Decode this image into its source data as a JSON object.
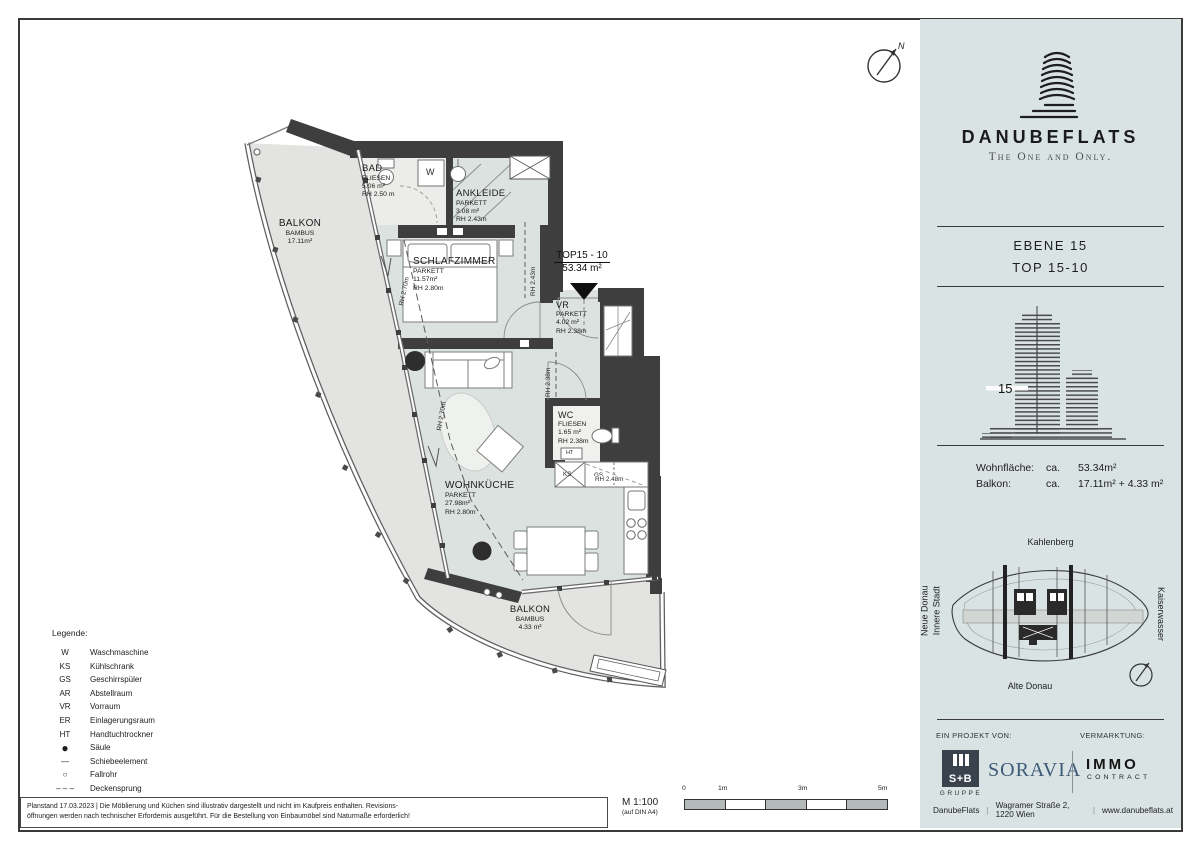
{
  "plan": {
    "compass": "N",
    "unit_callout": {
      "id": "TOP15 - 10",
      "area": "53.34 m²"
    },
    "rooms": {
      "balkon_left": {
        "name": "BALKON",
        "mat": "BAMBUS",
        "area": "17.11m²"
      },
      "bad": {
        "name": "BAD",
        "mat": "FLIESEN",
        "area": "5.06 m²",
        "rh": "RH 2.50 m"
      },
      "ankleide": {
        "name": "ANKLEIDE",
        "mat": "PARKETT",
        "area": "3.08 m²",
        "rh": "RH 2.43m"
      },
      "schlafzimmer": {
        "name": "SCHLAFZIMMER",
        "mat": "PARKETT",
        "area": "11.57m²",
        "rh": "RH 2.80m"
      },
      "vr": {
        "name": "VR",
        "mat": "PARKETT",
        "area": "4.02 m²",
        "rh": "RH 2.38m"
      },
      "wc": {
        "name": "WC",
        "mat": "FLIESEN",
        "area": "1.65 m²",
        "rh": "RH 2.38m"
      },
      "wohnkueche": {
        "name": "WOHNKÜCHE",
        "mat": "PARKETT",
        "area": "27.98m²",
        "rh": "RH 2.80m"
      },
      "balkon_bottom": {
        "name": "BALKON",
        "mat": "BAMBUS",
        "area": "4.33 m²"
      }
    },
    "dims": {
      "rh243": "RH 2.43m",
      "rh238": "RH 2.38m",
      "rh248": "RH 2.48m",
      "rh270a": "RH 2.70m",
      "rh270b": "RH 2.70m"
    },
    "fixtures": {
      "w": "W",
      "ks": "KS",
      "gs": "GS",
      "ht": "HT"
    }
  },
  "legend": {
    "title": "Legende:",
    "items": [
      {
        "sym": "W",
        "label": "Waschmaschine"
      },
      {
        "sym": "KS",
        "label": "Kühlschrank"
      },
      {
        "sym": "GS",
        "label": "Geschirrspüler"
      },
      {
        "sym": "AR",
        "label": "Abstellraum"
      },
      {
        "sym": "VR",
        "label": "Vorraum"
      },
      {
        "sym": "ER",
        "label": "Einlagerungsraum"
      },
      {
        "sym": "HT",
        "label": "Handtuchtrockner"
      },
      {
        "sym": "●",
        "label": "Säule"
      },
      {
        "sym": "—",
        "label": "Schiebeelement"
      },
      {
        "sym": "○",
        "label": "Fallrohr"
      },
      {
        "sym": "– – –",
        "label": "Deckensprung"
      }
    ]
  },
  "footnote": {
    "line1": "Planstand  17.03.2023 |  Die Möblierung und Küchen sind illustrativ dargestellt und nicht im Kaufpreis enthalten. Revisions-",
    "line2": "öffnungen werden nach technischer Erfordernis ausgeführt. Für die Bestellung von Einbaumöbel sind Naturmaße erforderlich!"
  },
  "scale": {
    "label": "M 1:100",
    "sub": "(auf DIN A4)",
    "ticks": [
      "0",
      "1m",
      "3m",
      "5m"
    ]
  },
  "sidebar": {
    "brand": {
      "name": "DANUBEFLATS",
      "tagline": "The One and Only."
    },
    "unit": {
      "level": "EBENE  15",
      "top": "TOP  15-10"
    },
    "floor_marker": "15",
    "areas": {
      "rows": [
        {
          "label": "Wohnfläche:",
          "ca": "ca.",
          "value": "53.34m²"
        },
        {
          "label": "Balkon:",
          "ca": "ca.",
          "value": "17.11m² + 4.33 m²"
        }
      ]
    },
    "map": {
      "north": "Kahlenberg",
      "south": "Alte Donau",
      "west1": "Neue Donau",
      "west2": "Innere Stadt",
      "east": "Kaiserwasser"
    },
    "partners": {
      "project_label": "EIN PROJEKT VON:",
      "marketing_label": "VERMARKTUNG:",
      "sb": {
        "name": "S+B",
        "sub": "GRUPPE"
      },
      "soravia": "SORAVIA",
      "immo": {
        "name": "IMMO",
        "sub": "CONTRACT"
      }
    },
    "footer": {
      "brand": "DanubeFlats",
      "address": "Wagramer Straße 2, 1220 Wien",
      "web": "www.danubeflats.at"
    }
  }
}
